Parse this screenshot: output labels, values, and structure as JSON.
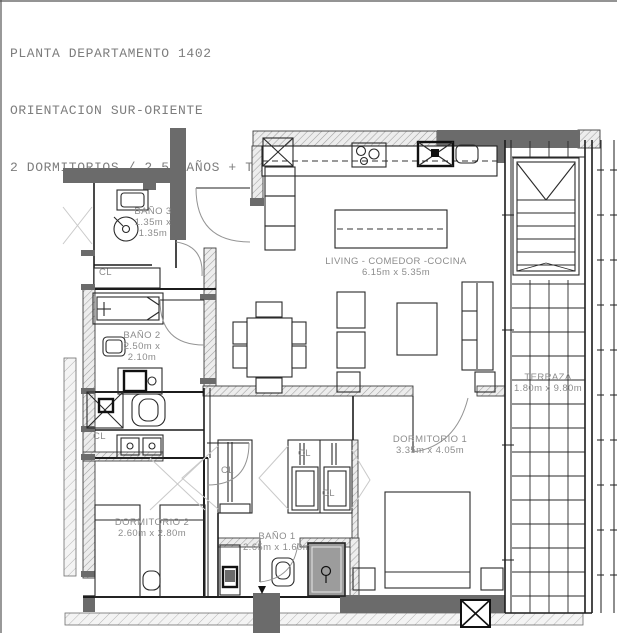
{
  "header": {
    "line1": "PLANTA DEPARTAMENTO 1402",
    "line2": "ORIENTACION SUR-ORIENTE",
    "line3": "2 DORMITORIOS / 2.5 BAÑOS + TERRAZA EXCLUSIVA EN PISO 15"
  },
  "rooms": {
    "living": {
      "name": "LIVING - COMEDOR -COCINA",
      "dims": "6.15m x 5.35m"
    },
    "terraza": {
      "name": "TERRAZA",
      "dims": "1.80m x 9.80m"
    },
    "dormitorio1": {
      "name": "DORMITORIO 1",
      "dims": "3.35m x 4.05m"
    },
    "dormitorio2": {
      "name": "DORMITORIO 2",
      "dims": "2.60m x 2.80m"
    },
    "bano1": {
      "name": "BAÑO 1",
      "dims": "2.65m x 1.60m"
    },
    "bano2": {
      "name": "BAÑO 2",
      "dims_line1": "2.50m x",
      "dims_line2": "2.10m"
    },
    "bano3": {
      "name": "BAÑO 3",
      "dims_line1": "1.35m x",
      "dims_line2": "1.35m"
    },
    "closet": "CL"
  },
  "colors": {
    "wall_dark": "#6b6b6b",
    "line": "#1c1c1c",
    "shower_fill": "#9c9c9c",
    "label_text": "#8c8c8c",
    "title_text": "#7d7d7d"
  }
}
